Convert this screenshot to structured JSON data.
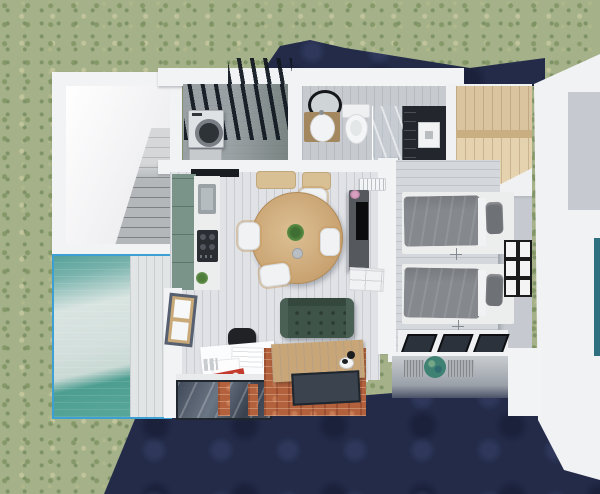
{
  "scene": {
    "title": "Top-down 3D architectural floor plan render",
    "view": "aerial top-down visualization of a small house",
    "environment": [
      "grass lawn",
      "dark navy shadow and paved ground",
      "swimming pool with deck",
      "slatted pergola"
    ]
  },
  "palette": {
    "grass": "#a4b189",
    "shadow_navy": "#232b49",
    "wall_white": "#f2f3f5",
    "wall_shade": "#c6cad0",
    "concrete": "#b4b7ba",
    "pool_border": "#3da0d4",
    "pool_water_deep": "#57a79a",
    "pool_water_pale": "#d7e3e0",
    "pool_deck": "#e2e5e5",
    "pergola_deck": "#9aa1a4",
    "pergola_slat": "#1a212a",
    "floor_living": "#e0e2e6",
    "floor_bath": "#c7cbcf",
    "floor_bedroom": "#d4d7db",
    "kitchen_green": "#7b948a",
    "counter_white": "#eceeee",
    "hob_black": "#191c20",
    "table_wood": "#cfa873",
    "chair_white": "#f0f2f3",
    "armrest_wood": "#c59c64",
    "cushion_tan": "#d8bf94",
    "sofa_green": "#3e5449",
    "tv_unit_gray": "#55585d",
    "tv_screen": "#0b0c0e",
    "sideboard_white": "#f1f2f4",
    "ac_white": "#f3f5f7",
    "bed_frame": "#eceded",
    "duvet_gray": "#85888d",
    "pillow_gray": "#6e7176",
    "frame_black": "#1b1b1b",
    "wardrobe_wood": "#d9c49f",
    "closet_floor_wood": "#e5d2ae",
    "vanity_wood": "#a3875f",
    "mirror_black": "#14161a",
    "shower_dark": "#23262c",
    "brick": "#b2613c",
    "bench_wood": "#c9a678",
    "glass_floor": "#4a5463",
    "desk_white": "#fbfcfd",
    "office_chair_black": "#202226",
    "art_red": "#c33b2f",
    "balcony_table_teal": "#3f8173",
    "lounger_gray": "#aeb1b4",
    "window_frame_dark": "#566070",
    "window_wood": "#caa978",
    "right_edge_teal": "#2e6f80",
    "washer_white": "#dfe2e4"
  },
  "rooms": [
    {
      "id": "stairwell",
      "label": "Stairwell with concrete stairs"
    },
    {
      "id": "pool",
      "label": "Swimming pool with blue rim and deck"
    },
    {
      "id": "laundry-patio",
      "label": "Laundry patio under slatted pergola",
      "furniture": [
        "washing machine",
        "low cabinet"
      ]
    },
    {
      "id": "bathroom",
      "label": "Bathroom",
      "furniture": [
        "round black-rim mirror",
        "wood vanity with white basin",
        "toilet",
        "glass shower screen",
        "dark shower closet",
        "white shower unit"
      ]
    },
    {
      "id": "closet-nook",
      "label": "Wardrobe nook",
      "furniture": [
        "light wood wardrobe",
        "wood floor"
      ]
    },
    {
      "id": "living-dining-kitchen",
      "label": "Open living, dining and kitchen",
      "furniture": [
        "sage green kitchen cabinets",
        "sink",
        "gas hob",
        "black cooker hood",
        "round wooden dining table with plant",
        "four white chairs with wood armrests",
        "tan bench cushions",
        "tall TV unit",
        "air conditioner",
        "white sideboard",
        "green tufted sofa",
        "white desk with papers and red artwork",
        "black office chair",
        "wooden bench",
        "black and white cat"
      ]
    },
    {
      "id": "bedroom",
      "label": "Twin bedroom",
      "furniture": [
        "two single beds with gray duvets",
        "gray pillows",
        "six framed pictures",
        "ceiling fans",
        "skylight band"
      ]
    },
    {
      "id": "lower-terrace",
      "label": "Lower terrace under overhang",
      "furniture": [
        "two woven loungers",
        "round teal side table"
      ]
    },
    {
      "id": "void",
      "label": "Double-height void with brick-framed glass floor panels"
    }
  ]
}
